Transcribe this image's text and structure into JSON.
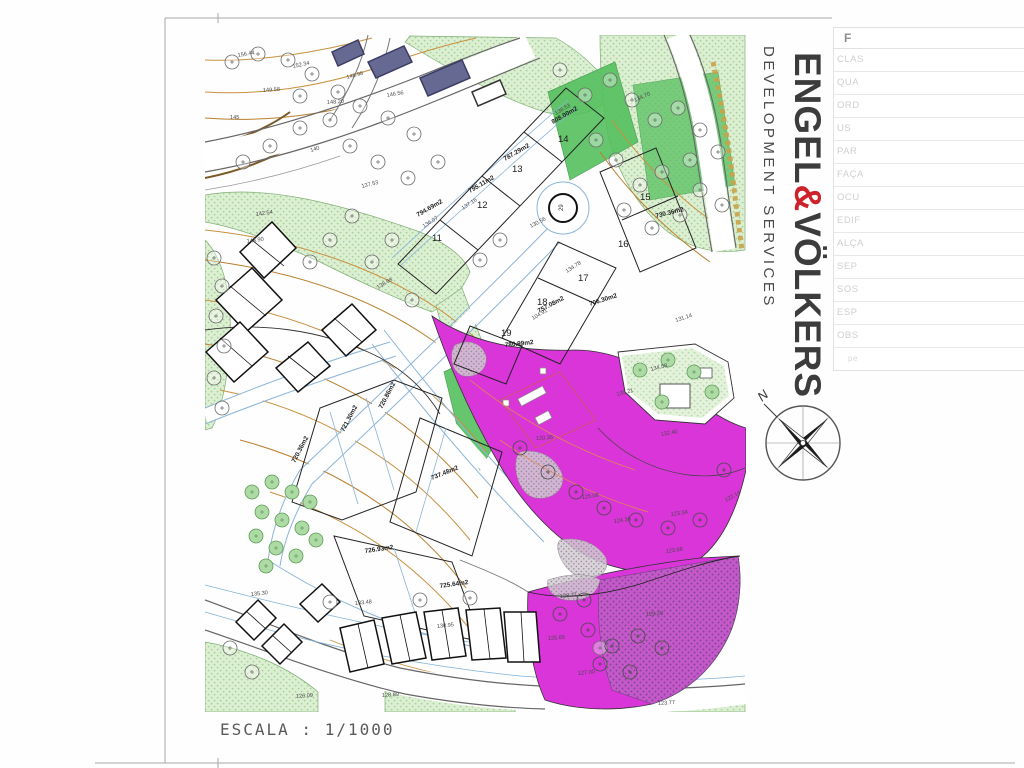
{
  "page": {
    "scale_label": "ESCALA : 1/1000"
  },
  "branding": {
    "pre": "ENGEL",
    "amp": "&",
    "post": "VÖLKERS",
    "sub": "DEVELOPMENT SERVICES",
    "accent_color": "#cc2229"
  },
  "compass": {
    "label": "N"
  },
  "legend_table": {
    "header": "F",
    "rows": [
      "CLAS",
      "QUA",
      "ORD",
      "US",
      "PAR",
      "FAÇA",
      "OCU",
      "EDIF",
      "ALÇA",
      "SEP",
      "SOS",
      "ESP",
      "OBS",
      "pe"
    ]
  },
  "map": {
    "colors": {
      "magenta": "#d935d9",
      "pale_green": "#d8eccb",
      "bright_green": "#55c05e",
      "contour": "#c8913f",
      "parcel_blue": "#8ab4d8"
    },
    "roundabout_label": {
      "t": "29",
      "x": 563,
      "y": 211,
      "r": -90
    },
    "plot_numbers": [
      {
        "t": "11",
        "x": 432,
        "y": 241,
        "r": 0
      },
      {
        "t": "12",
        "x": 477,
        "y": 208,
        "r": 0
      },
      {
        "t": "13",
        "x": 512,
        "y": 172,
        "r": 0
      },
      {
        "t": "14",
        "x": 558,
        "y": 142,
        "r": 0
      },
      {
        "t": "15",
        "x": 640,
        "y": 200,
        "r": 0
      },
      {
        "t": "16",
        "x": 618,
        "y": 247,
        "r": 0
      },
      {
        "t": "17",
        "x": 578,
        "y": 281,
        "r": 0
      },
      {
        "t": "18",
        "x": 537,
        "y": 305,
        "r": 0
      },
      {
        "t": "19",
        "x": 501,
        "y": 336,
        "r": 0
      }
    ],
    "plot_areas": [
      {
        "t": "808.00m2",
        "x": 553,
        "y": 124,
        "r": -30
      },
      {
        "t": "787.29m2",
        "x": 505,
        "y": 161,
        "r": -30
      },
      {
        "t": "795.11m2",
        "x": 470,
        "y": 193,
        "r": -30
      },
      {
        "t": "794.69m2",
        "x": 418,
        "y": 217,
        "r": -30
      },
      {
        "t": "730.36m2",
        "x": 656,
        "y": 218,
        "r": -14
      },
      {
        "t": "706.30m2",
        "x": 590,
        "y": 306,
        "r": -18
      },
      {
        "t": "757.08m2",
        "x": 539,
        "y": 313,
        "r": -28
      },
      {
        "t": "780.99m2",
        "x": 505,
        "y": 347,
        "r": -6
      },
      {
        "t": "720.36m2",
        "x": 295,
        "y": 463,
        "r": -62
      },
      {
        "t": "721.30m2",
        "x": 344,
        "y": 432,
        "r": -62
      },
      {
        "t": "720.86m2",
        "x": 382,
        "y": 409,
        "r": -62
      },
      {
        "t": "737.48m2",
        "x": 432,
        "y": 480,
        "r": -22
      },
      {
        "t": "726.93m2",
        "x": 365,
        "y": 553,
        "r": -8
      },
      {
        "t": "725.64m2",
        "x": 440,
        "y": 588,
        "r": -8
      }
    ],
    "spot_elevations": [
      {
        "t": "156.44",
        "x": 238,
        "y": 57,
        "r": -10
      },
      {
        "t": "152.34",
        "x": 293,
        "y": 68,
        "r": -12
      },
      {
        "t": "148.98",
        "x": 347,
        "y": 79,
        "r": -15
      },
      {
        "t": "149.58",
        "x": 263,
        "y": 92,
        "r": -4
      },
      {
        "t": "148.20",
        "x": 327,
        "y": 104,
        "r": -4
      },
      {
        "t": "146.56",
        "x": 387,
        "y": 97,
        "r": -10
      },
      {
        "t": "145",
        "x": 230,
        "y": 119,
        "r": 0
      },
      {
        "t": "140",
        "x": 311,
        "y": 152,
        "r": -18
      },
      {
        "t": "137.53",
        "x": 362,
        "y": 188,
        "r": -14
      },
      {
        "t": "142.54",
        "x": 256,
        "y": 216,
        "r": -8
      },
      {
        "t": "144.90",
        "x": 247,
        "y": 243,
        "r": -8
      },
      {
        "t": "138.98",
        "x": 378,
        "y": 289,
        "r": -30
      },
      {
        "t": "136.07",
        "x": 424,
        "y": 228,
        "r": -33
      },
      {
        "t": "137.16",
        "x": 463,
        "y": 210,
        "r": -33
      },
      {
        "t": "138.53",
        "x": 556,
        "y": 115,
        "r": -30
      },
      {
        "t": "134.70",
        "x": 635,
        "y": 102,
        "r": -24
      },
      {
        "t": "130.56",
        "x": 531,
        "y": 228,
        "r": -28
      },
      {
        "t": "134.78",
        "x": 567,
        "y": 273,
        "r": -33
      },
      {
        "t": "104.91",
        "x": 533,
        "y": 320,
        "r": -30
      },
      {
        "t": "131.14",
        "x": 676,
        "y": 322,
        "r": -18
      },
      {
        "t": "134.58",
        "x": 651,
        "y": 371,
        "r": -14
      },
      {
        "t": "135.21",
        "x": 617,
        "y": 396,
        "r": -14
      },
      {
        "t": "132.40",
        "x": 661,
        "y": 436,
        "r": -10
      },
      {
        "t": "120.36",
        "x": 536,
        "y": 440,
        "r": -4
      },
      {
        "t": "125.08",
        "x": 582,
        "y": 499,
        "r": -8
      },
      {
        "t": "124.36",
        "x": 614,
        "y": 523,
        "r": -8
      },
      {
        "t": "123.34",
        "x": 671,
        "y": 516,
        "r": -8
      },
      {
        "t": "123.68",
        "x": 666,
        "y": 553,
        "r": -8
      },
      {
        "t": "122.14",
        "x": 726,
        "y": 502,
        "r": -30
      },
      {
        "t": "128.77",
        "x": 560,
        "y": 598,
        "r": -6
      },
      {
        "t": "129.29",
        "x": 646,
        "y": 616,
        "r": -4
      },
      {
        "t": "125.65",
        "x": 548,
        "y": 640,
        "r": -4
      },
      {
        "t": "127.00",
        "x": 578,
        "y": 675,
        "r": -6
      },
      {
        "t": "123.77",
        "x": 658,
        "y": 705,
        "r": -4
      },
      {
        "t": "133.48",
        "x": 355,
        "y": 605,
        "r": -6
      },
      {
        "t": "130.95",
        "x": 437,
        "y": 628,
        "r": -6
      },
      {
        "t": "128.89",
        "x": 382,
        "y": 697,
        "r": -4
      },
      {
        "t": "126.09",
        "x": 296,
        "y": 698,
        "r": -4
      },
      {
        "t": "135.30",
        "x": 251,
        "y": 596,
        "r": -6
      }
    ]
  }
}
